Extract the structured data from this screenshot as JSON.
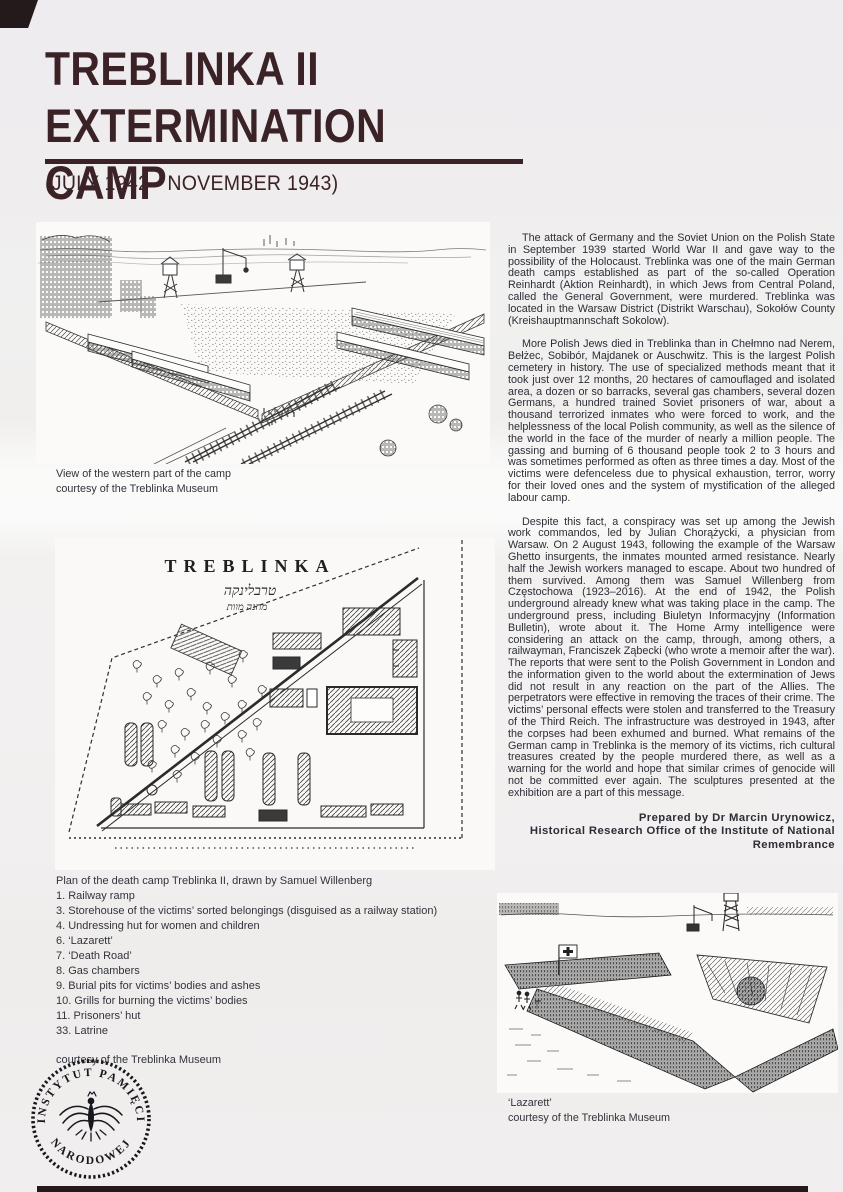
{
  "poster": {
    "title": "TREBLINKA II\nEXTERMINATION CAMP",
    "subtitle": "(JULY 1942 - NOVEMBER 1943)",
    "accent_color": "#3a2226",
    "footer_bar_color": "#241a1c"
  },
  "aerial": {
    "caption": "View of the western part of the camp\ncourtesy of the Treblinka Museum"
  },
  "plan": {
    "map_title": "TREBLINKA",
    "map_hebrew_line1": "טרבלינקה",
    "map_hebrew_line2": "מחנה מוות",
    "caption_title": "Plan of the death camp Treblinka II, drawn by Samuel Willenberg",
    "items": [
      "1. Railway ramp",
      "3. Storehouse of the victims’ sorted belongings (disguised as a railway station)",
      "4. Undressing hut for women and children",
      "6. ‘Lazarett’",
      "7. ‘Death Road’",
      "8. Gas chambers",
      "9. Burial pits for victims’ bodies and ashes",
      "10. Grills for burning the victims’ bodies",
      "11. Prisoners’ hut",
      "33. Latrine"
    ],
    "courtesy": "courtesy of the Treblinka Museum"
  },
  "article": {
    "paragraphs": [
      "The attack of Germany and the Soviet Union on the Polish State in September 1939 started World War II and gave way to the possibility of the Holocaust. Treblinka was one of the main German death camps established as part of the so-called Operation Reinhardt (Aktion Reinhardt), in which Jews from Central Poland, called the General Government, were murdered. Treblinka was located in the Warsaw District (Distrikt Warschau), Sokołów County (Kreishauptmannschaft Sokolow).",
      "More Polish Jews died in Treblinka than in Chełmno nad Nerem, Bełżec, Sobibór, Majdanek or Auschwitz. This is the largest Polish cemetery in history. The use of specialized methods meant that it took just over 12 months, 20 hectares of camouflaged and isolated area, a dozen or so barracks, several gas chambers, several dozen Germans, a hundred trained Soviet prisoners of war, about a thousand terrorized inmates who were forced to work, and the helplessness of the local Polish community, as well as the silence of the world in the face of the murder of nearly a million people. The gassing and burning of 6 thousand people took 2 to 3 hours and was sometimes performed as often as three times a day. Most of the victims were defenceless due to physical exhaustion, terror, worry for their loved ones and the system of mystification of the alleged labour camp.",
      "Despite this fact, a conspiracy was set up among the Jewish work commandos, led by Julian Chorążycki, a physician from Warsaw. On 2 August 1943, following the example of the Warsaw Ghetto insurgents, the inmates mounted armed resistance. Nearly half the Jewish workers managed to escape. About two hundred of them survived. Among them was Samuel Willenberg from Częstochowa (1923–2016). At the end of 1942, the Polish underground already knew what was taking place in the camp. The underground press, including Biuletyn Informacyjny (Information Bulletin), wrote about it. The Home Army intelligence were considering an attack on the camp, through, among others, a railwayman, Franciszek Ząbecki (who wrote a memoir after the war). The reports that were sent to the Polish Government in London and the information given to the world about the extermination of Jews did not result in any reaction on the part of the Allies. The perpetrators were effective in removing the traces of their crime. The victims’ personal effects were stolen and transferred to the Treasury of the Third Reich. The infrastructure was destroyed in 1943, after the corpses had been exhumed and burned. What remains of the German camp in Treblinka is the memory of its victims, rich cultural treasures created by the people murdered there, as well as a warning for the world and hope that similar crimes of genocide will not be committed ever again. The sculptures presented at the exhibition are a part of this message."
    ],
    "credit": "Prepared by Dr Marcin Urynowicz,\nHistorical Research Office of the Institute of National\nRemembrance"
  },
  "lazarett": {
    "caption": "‘Lazarett’\ncourtesy of the Treblinka Museum"
  },
  "seal": {
    "top_text": "INSTYTUT PAMIĘCI",
    "bottom_text": "NARODOWEJ"
  }
}
